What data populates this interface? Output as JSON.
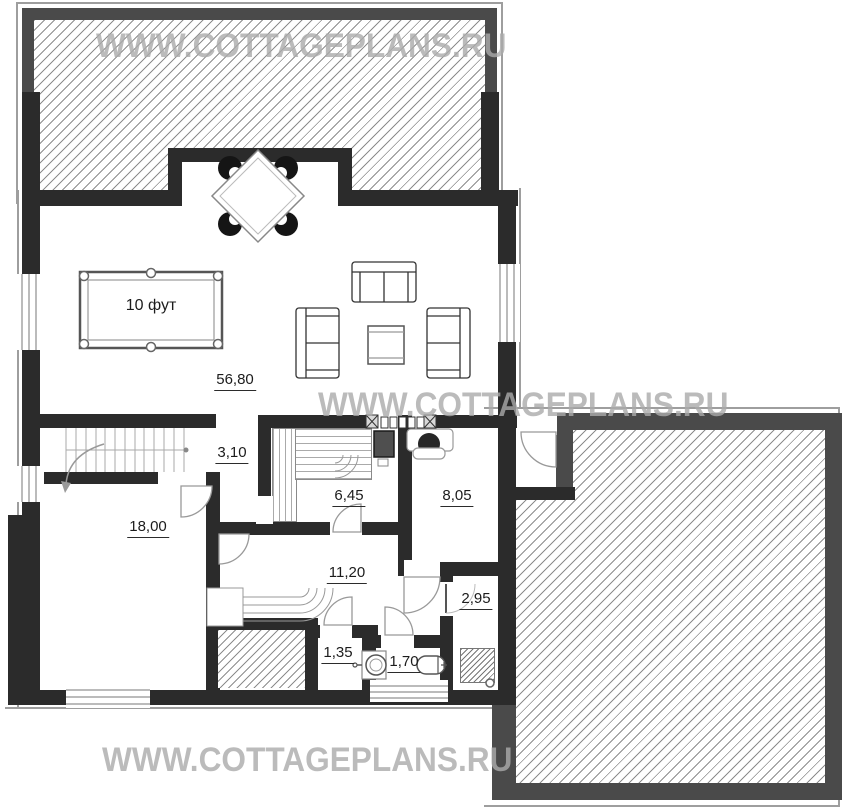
{
  "watermark": {
    "text": "WWW.COTTAGEPLANS.RU"
  },
  "plan": {
    "areas": {
      "living": "56,80",
      "hall": "3,10",
      "sauna": "6,45",
      "study": "8,05",
      "bedroom": "18,00",
      "corridor": "11,20",
      "shower_room": "2,95",
      "closet": "1,35",
      "bathroom": "1,70"
    },
    "pool_table_size": "10 фут"
  },
  "colors": {
    "wall": "#2b2b2b",
    "terrace_border": "#4a4a4a",
    "hatch_line": "#8d8d8d",
    "watermark": "#aaaaaa"
  }
}
